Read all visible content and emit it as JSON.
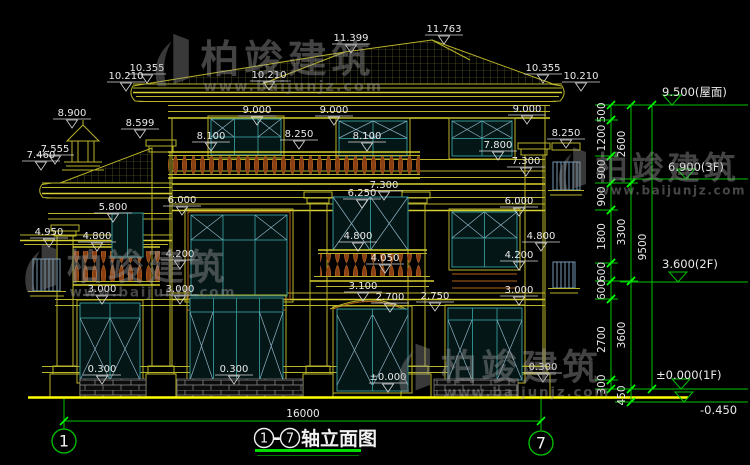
{
  "page": {
    "width": 750,
    "height": 465,
    "background": "#000000"
  },
  "colors": {
    "building_line": "#b9b429",
    "ground_line": "#ffff00",
    "dimension_green": "#00c400",
    "annotation_white": "#eaeaea",
    "window_teal": "#2e8b8b",
    "railing_brown": "#a0522d",
    "trim_orange": "#b5651d",
    "watermark_gray": "#9c9c9c"
  },
  "watermark": {
    "brand": "柏竣建筑",
    "url": "www.baijunjz.com"
  },
  "elevation_labels": [
    {
      "t": "11.763",
      "x": 444,
      "y": 32
    },
    {
      "t": "11.399",
      "x": 351,
      "y": 41
    },
    {
      "t": "10.210",
      "x": 126,
      "y": 79
    },
    {
      "t": "10.355",
      "x": 147,
      "y": 71
    },
    {
      "t": "10.210",
      "x": 269,
      "y": 78
    },
    {
      "t": "10.355",
      "x": 543,
      "y": 71
    },
    {
      "t": "10.210",
      "x": 581,
      "y": 79
    },
    {
      "t": "8.900",
      "x": 72,
      "y": 116
    },
    {
      "t": "8.599",
      "x": 140,
      "y": 126
    },
    {
      "t": "7.460",
      "x": 41,
      "y": 158
    },
    {
      "t": "7.555",
      "x": 55,
      "y": 152
    },
    {
      "t": "9.000",
      "x": 257,
      "y": 113
    },
    {
      "t": "9.000",
      "x": 334,
      "y": 113
    },
    {
      "t": "9.000",
      "x": 527,
      "y": 112
    },
    {
      "t": "8.100",
      "x": 211,
      "y": 139
    },
    {
      "t": "8.100",
      "x": 367,
      "y": 139
    },
    {
      "t": "8.250",
      "x": 299,
      "y": 137
    },
    {
      "t": "8.250",
      "x": 566,
      "y": 136
    },
    {
      "t": "7.800",
      "x": 498,
      "y": 148
    },
    {
      "t": "7.300",
      "x": 526,
      "y": 164
    },
    {
      "t": "7.300",
      "x": 384,
      "y": 188
    },
    {
      "t": "6.250",
      "x": 362,
      "y": 196
    },
    {
      "t": "6.000",
      "x": 182,
      "y": 203
    },
    {
      "t": "6.000",
      "x": 519,
      "y": 204
    },
    {
      "t": "5.800",
      "x": 113,
      "y": 210
    },
    {
      "t": "4.950",
      "x": 49,
      "y": 235
    },
    {
      "t": "4.800",
      "x": 97,
      "y": 239
    },
    {
      "t": "4.800",
      "x": 358,
      "y": 239
    },
    {
      "t": "4.800",
      "x": 541,
      "y": 239
    },
    {
      "t": "4.200",
      "x": 180,
      "y": 257
    },
    {
      "t": "4.200",
      "x": 519,
      "y": 258
    },
    {
      "t": "4.050",
      "x": 385,
      "y": 261
    },
    {
      "t": "3.100",
      "x": 363,
      "y": 289
    },
    {
      "t": "3.000",
      "x": 102,
      "y": 292
    },
    {
      "t": "3.000",
      "x": 180,
      "y": 292
    },
    {
      "t": "3.000",
      "x": 519,
      "y": 293
    },
    {
      "t": "2.700",
      "x": 390,
      "y": 300
    },
    {
      "t": "2.750",
      "x": 435,
      "y": 299
    },
    {
      "t": "0.300",
      "x": 102,
      "y": 372
    },
    {
      "t": "0.300",
      "x": 234,
      "y": 372
    },
    {
      "t": "0.300",
      "x": 543,
      "y": 370
    },
    {
      "t": "±0.000",
      "x": 388,
      "y": 380
    }
  ],
  "dim_chains": [
    {
      "x": 611,
      "segments": [
        [
          "500",
          105,
          120
        ],
        [
          "1200",
          120,
          156
        ],
        [
          "900",
          156,
          183
        ],
        [
          "900",
          183,
          210
        ],
        [
          "1800",
          210,
          263
        ],
        [
          "600",
          263,
          281
        ],
        [
          "600",
          281,
          299
        ],
        [
          "2700",
          299,
          380
        ],
        [
          "300",
          380,
          389
        ]
      ]
    },
    {
      "x": 631,
      "segments": [
        [
          "2600",
          105,
          183
        ],
        [
          "3300",
          183,
          281
        ],
        [
          "3600",
          281,
          389
        ],
        [
          "450",
          389,
          402
        ]
      ]
    },
    {
      "x": 652,
      "segments": [
        [
          "9500",
          105,
          389
        ]
      ]
    }
  ],
  "level_markers": [
    {
      "t": "9.500(屋面)",
      "y": 105,
      "ax": 672,
      "tx": 662,
      "ty": 96
    },
    {
      "t": "6.900(3F)",
      "y": 179,
      "ax": 686,
      "tx": 668,
      "ty": 171
    },
    {
      "t": "3.600(2F)",
      "y": 282,
      "ax": 678,
      "tx": 662,
      "ty": 268
    },
    {
      "t": "±0.000(1F)",
      "y": 389,
      "ax": 681,
      "tx": 656,
      "ty": 379
    },
    {
      "t": "-0.450",
      "y": 402,
      "ax": 684,
      "tx": 700,
      "ty": 414
    }
  ],
  "bottom": {
    "overall_dim": "16000",
    "axis_start": "1",
    "axis_end": "7",
    "title_dash": "-",
    "title_name": "轴立面图"
  }
}
